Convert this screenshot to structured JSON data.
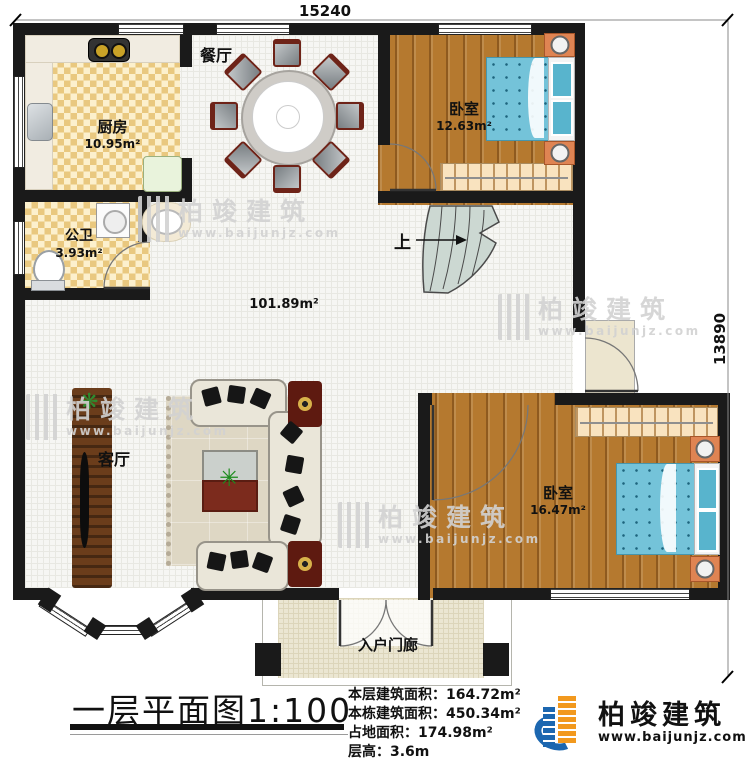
{
  "plan": {
    "dim_top": "15240",
    "dim_right": "13890",
    "rooms": {
      "kitchen": {
        "name": "厨房",
        "area": "10.95m²"
      },
      "dining": {
        "name": "餐厅"
      },
      "bedroom1": {
        "name": "卧室",
        "area": "12.63m²"
      },
      "bathroom": {
        "name": "公卫",
        "area": "3.93m²"
      },
      "hall": {
        "area": "101.89m²"
      },
      "living": {
        "name": "客厅"
      },
      "bedroom2": {
        "name": "卧室",
        "area": "16.47m²"
      },
      "porch": {
        "name": "入户门廊"
      }
    },
    "stairs_label": "上"
  },
  "footer": {
    "title": "一层平面图",
    "scale": "1:100",
    "stats": [
      {
        "label": "本层建筑面积：",
        "value": "164.72m²"
      },
      {
        "label": "本栋建筑面积：",
        "value": "450.34m²"
      },
      {
        "label": "占地面积：",
        "value": "174.98m²"
      },
      {
        "label": "层高：",
        "value": "3.6m"
      }
    ],
    "brand": {
      "name": "柏竣建筑",
      "site": "www.baijunjz.com"
    }
  },
  "watermark": {
    "name": "柏竣建筑",
    "site": "www.baijunjz.com"
  },
  "colors": {
    "wall": "#1a1a1a",
    "wood": "#b5792f",
    "bed": "#74c3d9",
    "checker": "#e9c87f",
    "brand_blue": "#1c67b0",
    "brand_orange": "#f2991e"
  }
}
